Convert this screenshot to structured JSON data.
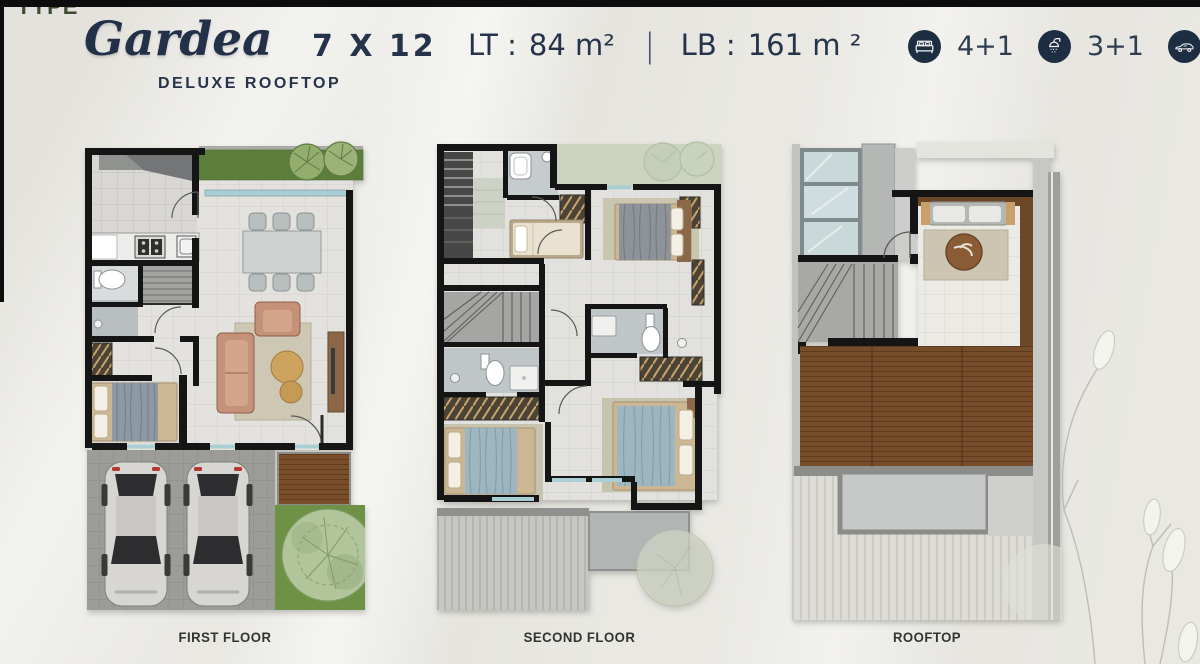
{
  "page": {
    "type_label": "TYPE"
  },
  "header": {
    "brand": "Gardea",
    "subtitle": "DELUXE ROOFTOP",
    "dimensions": "7 X 12",
    "land": {
      "label": "LT :",
      "value": "84 m²"
    },
    "separator": "|",
    "building": {
      "label": "LB :",
      "value": "161 m ²"
    },
    "specs": [
      {
        "icon": "bed-icon",
        "value": "4+1"
      },
      {
        "icon": "shower-icon",
        "value": "3+1"
      },
      {
        "icon": "car-icon",
        "value": "2"
      }
    ]
  },
  "colors": {
    "accent_navy": "#25344a",
    "icon_circle": "#1e2e42",
    "type_green": "#3f4b2e",
    "garden_green": "#5b7f3a",
    "deck_brown": "#774c28",
    "background": "#e9e8e3"
  },
  "floorplans": [
    {
      "id": "first-floor",
      "label": "FIRST FLOOR"
    },
    {
      "id": "second-floor",
      "label": "SECOND FLOOR"
    },
    {
      "id": "rooftop",
      "label": "ROOFTOP"
    }
  ]
}
